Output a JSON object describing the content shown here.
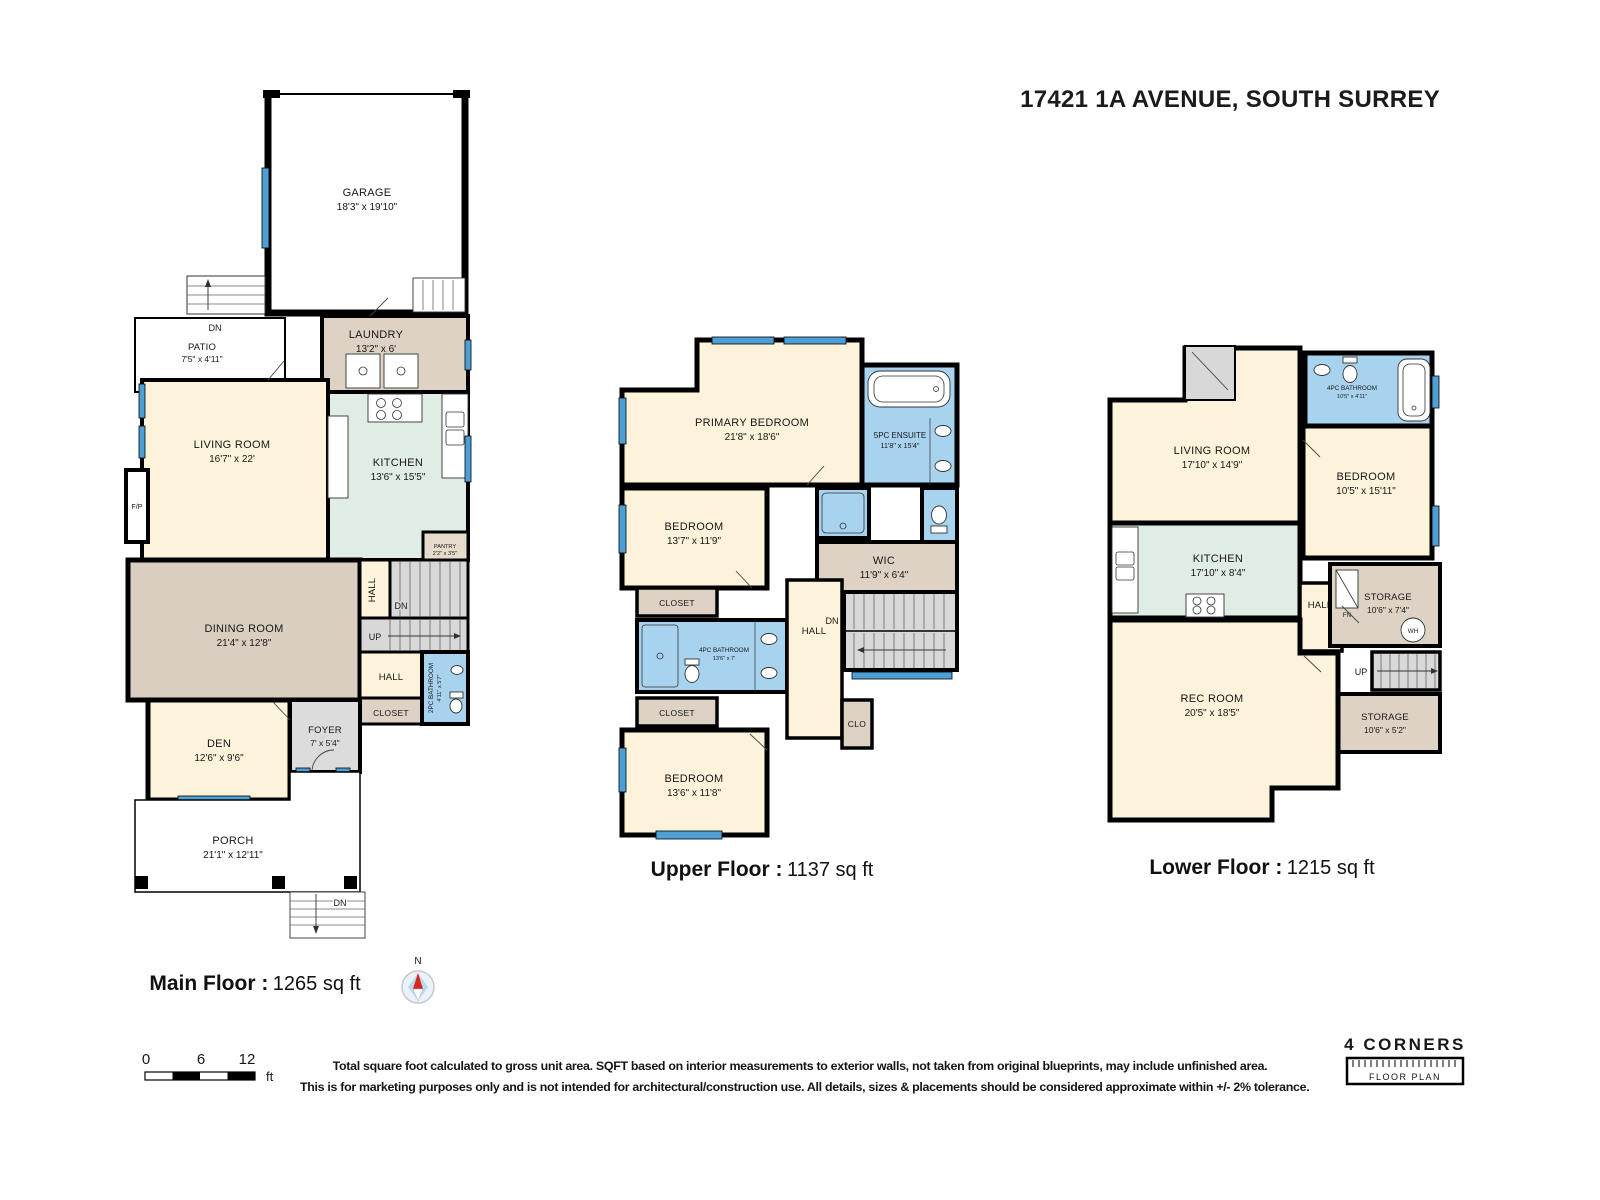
{
  "title": "17421 1A AVENUE, SOUTH SURREY",
  "labels": {
    "dn": "DN",
    "up": "UP",
    "hall": "HALL",
    "closet": "CLOSET",
    "clo": "CLO",
    "fp": "F/P",
    "wh": "WH",
    "fn": "FN",
    "north": "N"
  },
  "colors": {
    "wall": "#000000",
    "window": "#4d9fd6",
    "room_cream": "#fcf3da",
    "room_tan": "#d9cec0",
    "room_tan_light": "#ddd2c3",
    "room_green": "#dfede4",
    "room_blue": "#a8d3ef",
    "stairs_gray": "#d8d8d8",
    "compass_red": "#d9251d"
  },
  "floors": {
    "main": {
      "caption": "Main Floor :",
      "sqft": "1265 sq ft",
      "rooms": {
        "garage": {
          "name": "GARAGE",
          "dims": "18'3\" x 19'10\""
        },
        "patio": {
          "name": "PATIO",
          "dims": "7'5\" x 4'11\""
        },
        "laundry": {
          "name": "LAUNDRY",
          "dims": "13'2\" x 6'"
        },
        "living": {
          "name": "LIVING ROOM",
          "dims": "16'7\" x 22'"
        },
        "kitchen": {
          "name": "KITCHEN",
          "dims": "13'6\" x 15'5\""
        },
        "pantry": {
          "name": "PANTRY",
          "dims": "2'2\" x 3'5\""
        },
        "dining": {
          "name": "DINING ROOM",
          "dims": "21'4\" x 12'8\""
        },
        "bath": {
          "name": "2PC BATHROOM",
          "dims": "4'11\" x 5'7\""
        },
        "den": {
          "name": "DEN",
          "dims": "12'6\" x 9'6\""
        },
        "foyer": {
          "name": "FOYER",
          "dims": "7' x 5'4\""
        },
        "porch": {
          "name": "PORCH",
          "dims": "21'1\" x 12'11\""
        }
      }
    },
    "upper": {
      "caption": "Upper Floor :",
      "sqft": "1137 sq ft",
      "rooms": {
        "primary": {
          "name": "PRIMARY BEDROOM",
          "dims": "21'8\" x 18'6\""
        },
        "ensuite": {
          "name": "5PC ENSUITE",
          "dims": "11'8\" x 15'4\""
        },
        "wic": {
          "name": "WIC",
          "dims": "11'9\" x 6'4\""
        },
        "bedroom2": {
          "name": "BEDROOM",
          "dims": "13'7\" x 11'9\""
        },
        "bath": {
          "name": "4PC BATHROOM",
          "dims": "13'6\" x 7'"
        },
        "bedroom3": {
          "name": "BEDROOM",
          "dims": "13'6\" x 11'8\""
        }
      }
    },
    "lower": {
      "caption": "Lower Floor :",
      "sqft": "1215 sq ft",
      "rooms": {
        "living": {
          "name": "LIVING ROOM",
          "dims": "17'10\" x 14'9\""
        },
        "bath": {
          "name": "4PC BATHROOM",
          "dims": "10'5\" x 4'11\""
        },
        "bedroom": {
          "name": "BEDROOM",
          "dims": "10'5\" x 15'11\""
        },
        "kitchen": {
          "name": "KITCHEN",
          "dims": "17'10\" x 8'4\""
        },
        "storage1": {
          "name": "STORAGE",
          "dims": "10'6\" x 7'4\""
        },
        "storage2": {
          "name": "STORAGE",
          "dims": "10'6\" x 5'2\""
        },
        "rec": {
          "name": "REC ROOM",
          "dims": "20'5\" x 18'5\""
        }
      }
    }
  },
  "scalebar": {
    "t0": "0",
    "t1": "6",
    "t2": "12",
    "unit": "ft"
  },
  "disclaimer": {
    "line1": "Total square foot calculated to gross unit area. SQFT based on interior measurements to exterior walls, not taken from original blueprints, may include unfinished area.",
    "line2": "This is for marketing purposes only and is not intended for architectural/construction use. All details, sizes & placements should be considered approximate within +/- 2% tolerance."
  },
  "logo": {
    "name": "4 CORNERS",
    "sub": "FLOOR PLAN"
  }
}
